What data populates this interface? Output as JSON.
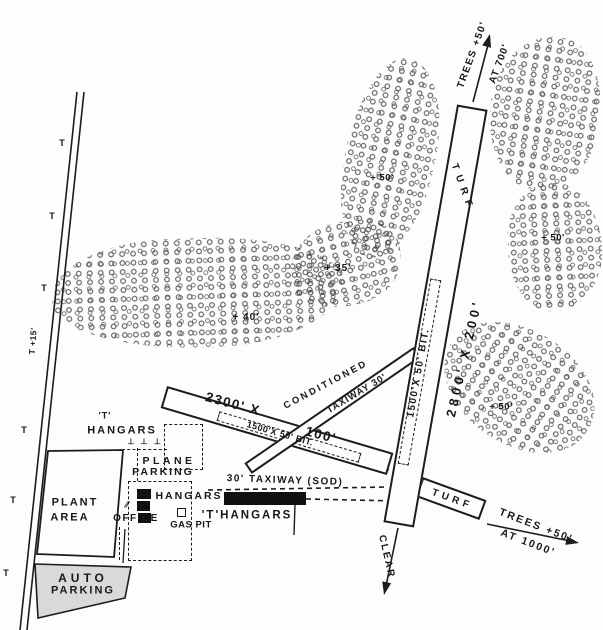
{
  "colors": {
    "ink": "#1c1c1c",
    "paper": "#fdfdfb",
    "auto_parking_fill": "#d9d9d9",
    "hangar_fill": "#111111"
  },
  "map": {
    "labels": [
      {
        "name": "trees-ne-height-label",
        "text": "TREES +50'",
        "x": 473,
        "y": 55,
        "rot": -70,
        "fs": 10,
        "ls": 1.5
      },
      {
        "name": "trees-ne-distance-label",
        "text": "AT 700'",
        "x": 500,
        "y": 64,
        "rot": -70,
        "fs": 10,
        "ls": 1
      },
      {
        "name": "runway-surface-label-top",
        "text": "TURF",
        "x": 462,
        "y": 188,
        "rot": 70,
        "fs": 10,
        "ls": 6
      },
      {
        "name": "runway-dimensions-label",
        "text": "2800' X 200'",
        "x": 464,
        "y": 358,
        "rot": -77,
        "fs": 13,
        "ls": 4
      },
      {
        "name": "runway-bit-strip-label",
        "text": "1500'X 50' BIT.",
        "x": 419,
        "y": 373,
        "rot": -80,
        "fs": 10,
        "ls": 1.5
      },
      {
        "name": "strip-dimensions-label-1",
        "text": "2300' X",
        "x": 233,
        "y": 404,
        "rot": 15,
        "fs": 13.5,
        "ls": 1.5
      },
      {
        "name": "strip-dimensions-label-2",
        "text": "100'",
        "x": 321,
        "y": 435,
        "rot": 15,
        "fs": 13.5,
        "ls": 1.5
      },
      {
        "name": "strip-conditioned-label",
        "text": "CONDITIONED",
        "x": 326,
        "y": 385,
        "rot": -28,
        "fs": 9.5,
        "ls": 2.5
      },
      {
        "name": "taxiway-30-label",
        "text": "TAXIWAY 30'",
        "x": 357,
        "y": 394,
        "rot": -31,
        "fs": 9.5,
        "ls": 1
      },
      {
        "name": "strip-bit-strip-label",
        "text": "1500'X 50' BIT.",
        "x": 280,
        "y": 434,
        "rot": 16,
        "fs": 9,
        "ls": 0.5
      },
      {
        "name": "sod-taxiway-label",
        "text": "30' TAXIWAY (SOD)",
        "x": 285,
        "y": 481,
        "rot": 2,
        "fs": 10,
        "ls": 1.5
      },
      {
        "name": "turf-stub-label",
        "text": "TURF",
        "x": 452,
        "y": 500,
        "rot": 20,
        "fs": 10,
        "ls": 4
      },
      {
        "name": "trees-se-height-label",
        "text": "TREES +50'",
        "x": 536,
        "y": 526,
        "rot": 21,
        "fs": 10.5,
        "ls": 2
      },
      {
        "name": "trees-se-distance-label",
        "text": "AT 1000'",
        "x": 528,
        "y": 543,
        "rot": 21,
        "fs": 10.5,
        "ls": 2
      },
      {
        "name": "clear-approach-label",
        "text": "CLEAR",
        "x": 386,
        "y": 557,
        "rot": 77,
        "fs": 10,
        "ls": 2
      },
      {
        "name": "plant-area-label-1",
        "text": "PLANT",
        "x": 75,
        "y": 503,
        "rot": 0,
        "fs": 11,
        "ls": 2
      },
      {
        "name": "plant-area-label-2",
        "text": "AREA",
        "x": 70,
        "y": 518,
        "rot": 0,
        "fs": 11,
        "ls": 2
      },
      {
        "name": "auto-parking-label-1",
        "text": "AUTO",
        "x": 83,
        "y": 578,
        "rot": 0,
        "fs": 12,
        "ls": 4
      },
      {
        "name": "auto-parking-label-2",
        "text": "PARKING",
        "x": 83,
        "y": 591,
        "rot": 0,
        "fs": 11,
        "ls": 2
      },
      {
        "name": "t-hangars-nw-label-1",
        "text": "'T'",
        "x": 105,
        "y": 416,
        "rot": 0,
        "fs": 9,
        "ls": 1
      },
      {
        "name": "t-hangars-nw-label-2",
        "text": "HANGARS",
        "x": 122,
        "y": 431,
        "rot": 0,
        "fs": 11,
        "ls": 2
      },
      {
        "name": "t-hangar-symbols",
        "text": "⊥ ⊥ ⊥",
        "x": 145,
        "y": 442,
        "rot": 0,
        "fs": 8,
        "ls": 2
      },
      {
        "name": "plane-parking-label-1",
        "text": "PLANE",
        "x": 169,
        "y": 461,
        "rot": 0,
        "fs": 10.5,
        "ls": 3.5
      },
      {
        "name": "plane-parking-label-2",
        "text": "PARKING",
        "x": 163,
        "y": 472,
        "rot": 0,
        "fs": 10.5,
        "ls": 2
      },
      {
        "name": "hangars-label",
        "text": "HANGARS",
        "x": 189,
        "y": 496,
        "rot": 0,
        "fs": 10.5,
        "ls": 2
      },
      {
        "name": "office-label",
        "text": "OFFICE",
        "x": 136,
        "y": 519,
        "rot": 0,
        "fs": 10,
        "ls": 1.5
      },
      {
        "name": "office-hatch-mark",
        "text": "∕∕",
        "x": 127,
        "y": 505,
        "rot": 0,
        "fs": 9,
        "ls": 0
      },
      {
        "name": "gas-pit-label",
        "text": "GAS PIT",
        "x": 191,
        "y": 525,
        "rot": 0,
        "fs": 9.5,
        "ls": 0.5
      },
      {
        "name": "t-hangars-east-label",
        "text": "'T'HANGARS",
        "x": 247,
        "y": 516,
        "rot": 0,
        "fs": 11.5,
        "ls": 2
      },
      {
        "name": "tree-height-35",
        "text": "+ 35'",
        "x": 338,
        "y": 269,
        "rot": 0,
        "fs": 10,
        "ls": 1
      },
      {
        "name": "tree-height-40",
        "text": "+ 40'",
        "x": 246,
        "y": 318,
        "rot": 0,
        "fs": 10,
        "ls": 1
      },
      {
        "name": "tree-height-50-mid",
        "text": "+ 50'",
        "x": 382,
        "y": 178,
        "rot": 0,
        "fs": 9.5,
        "ls": 0.5
      },
      {
        "name": "tree-height-50-east",
        "text": "+ 50'",
        "x": 553,
        "y": 238,
        "rot": 0,
        "fs": 9.5,
        "ls": 0.5
      },
      {
        "name": "tree-height-50-south",
        "text": "+ 50'",
        "x": 501,
        "y": 407,
        "rot": 0,
        "fs": 9.5,
        "ls": 0.5
      },
      {
        "name": "pole-height-label",
        "text": "T +15'",
        "x": 33,
        "y": 341,
        "rot": -86,
        "fs": 8.5,
        "ls": 0.5
      }
    ],
    "pole_markers": [
      {
        "glyph": "T",
        "x": 62,
        "y": 143
      },
      {
        "glyph": "T",
        "x": 52,
        "y": 216
      },
      {
        "glyph": "T",
        "x": 44,
        "y": 288
      },
      {
        "glyph": "T",
        "x": 24,
        "y": 430
      },
      {
        "glyph": "T",
        "x": 13,
        "y": 500
      },
      {
        "glyph": "T",
        "x": 6,
        "y": 573
      }
    ],
    "tree_clusters": [
      {
        "x": 52,
        "y": 238,
        "w": 290,
        "h": 110,
        "rot": -2,
        "br": "45% 55% 50% 60% / 55% 45% 60% 50%"
      },
      {
        "x": 288,
        "y": 222,
        "w": 114,
        "h": 84,
        "rot": -14,
        "br": "50% 50% 45% 55% / 60% 40% 55% 45%"
      },
      {
        "x": 345,
        "y": 57,
        "w": 90,
        "h": 202,
        "rot": 12,
        "br": "48% 52% 50% 50% / 52% 48% 50% 50%"
      },
      {
        "x": 490,
        "y": 36,
        "w": 110,
        "h": 154,
        "rot": 8,
        "br": "55% 45% 52% 48% / 48% 52% 45% 55%"
      },
      {
        "x": 508,
        "y": 183,
        "w": 94,
        "h": 128,
        "rot": -3,
        "br": "50% 50% 55% 45% / 45% 55% 50% 50%"
      },
      {
        "x": 438,
        "y": 330,
        "w": 162,
        "h": 114,
        "rot": 33,
        "br": "52% 48% 50% 50% / 50% 50% 48% 52%"
      }
    ]
  }
}
